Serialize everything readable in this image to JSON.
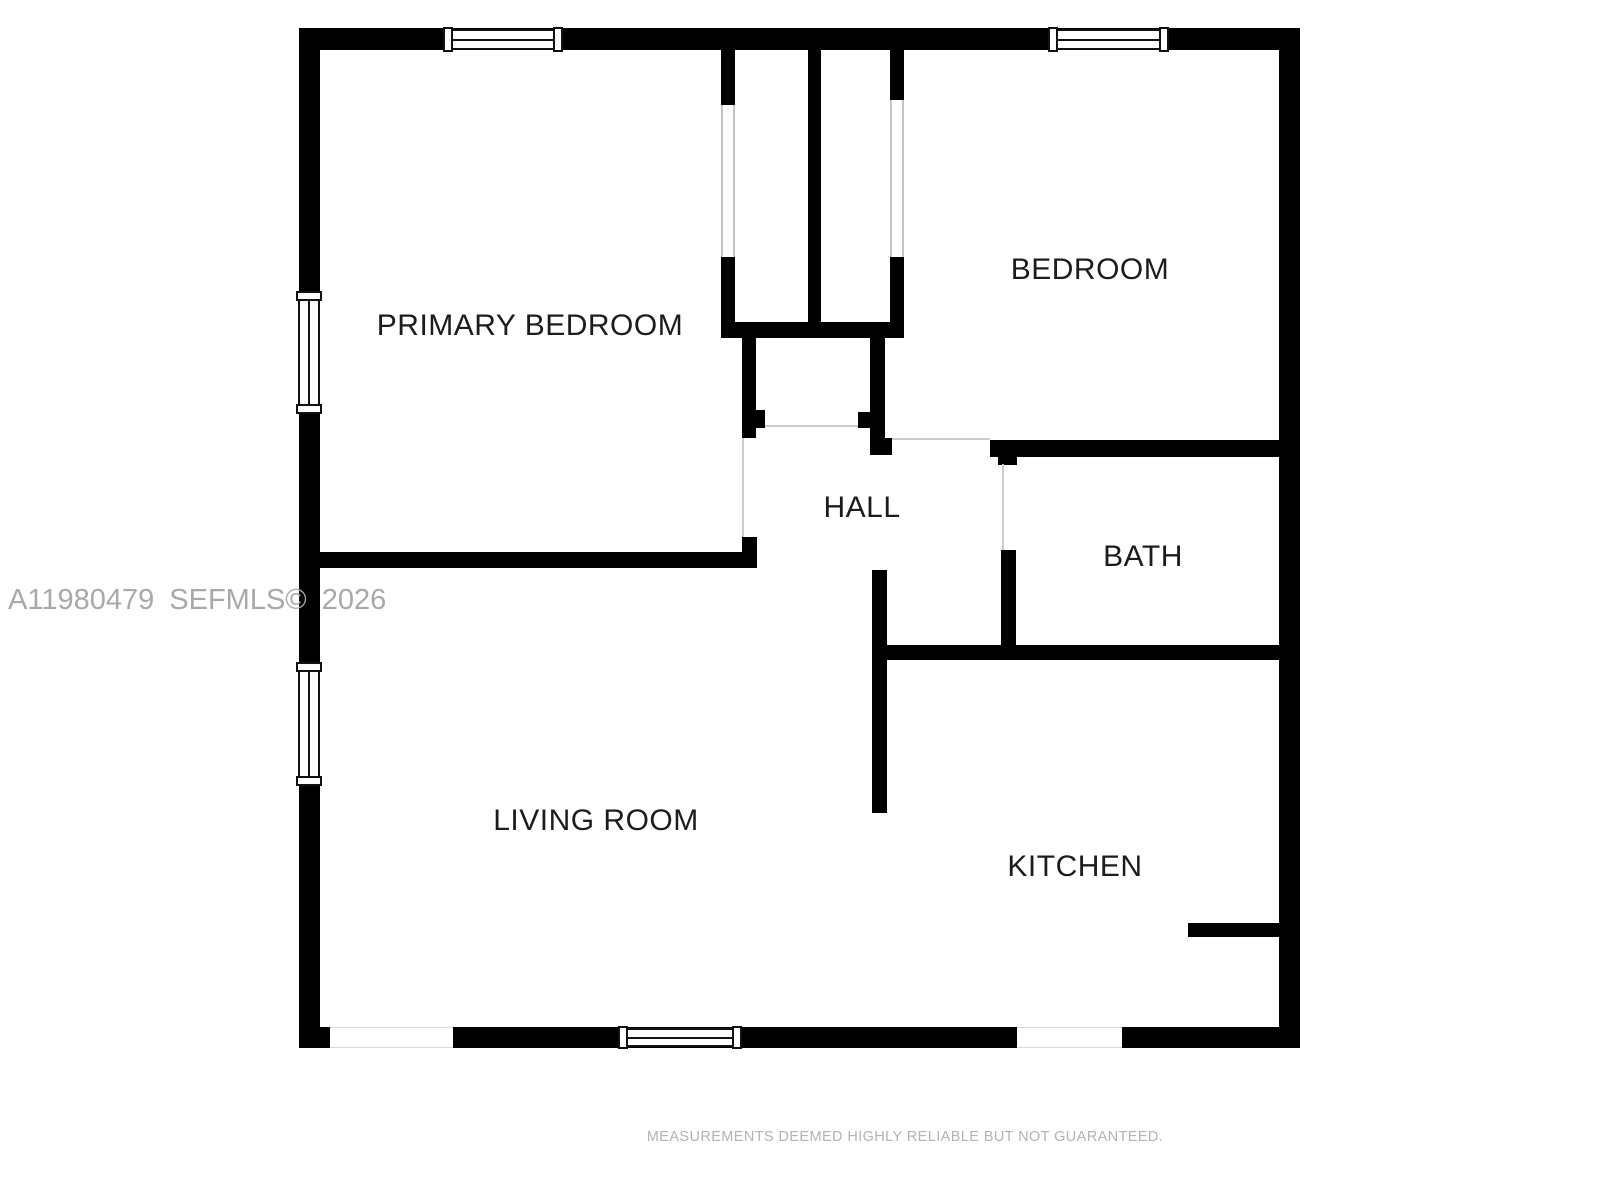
{
  "floorplan": {
    "rooms": {
      "primary_bedroom": {
        "label": "PRIMARY BEDROOM"
      },
      "bedroom": {
        "label": "BEDROOM"
      },
      "hall": {
        "label": "HALL"
      },
      "bath": {
        "label": "BATH"
      },
      "living_room": {
        "label": "LIVING ROOM"
      },
      "kitchen": {
        "label": "KITCHEN"
      }
    },
    "watermark": {
      "text": "A11980479 SEFMLS© 2026"
    },
    "disclaimer": {
      "text": "MEASUREMENTS DEEMED HIGHLY RELIABLE BUT NOT GUARANTEED."
    },
    "colors": {
      "wall": "#000000",
      "background": "#ffffff",
      "room_label": "#1c1c1c",
      "window_frame": "#111111",
      "opening_line": "#cccccc",
      "watermark": "#a9a9a9",
      "disclaimer": "#b3b3b3"
    }
  }
}
